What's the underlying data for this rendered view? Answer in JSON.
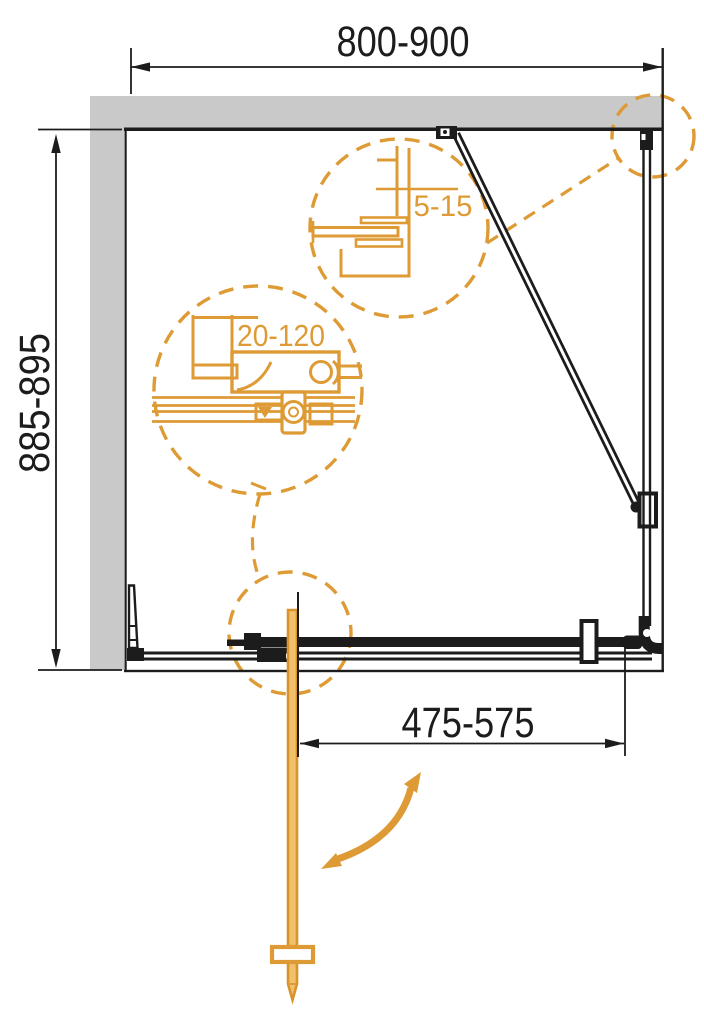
{
  "dimensions": {
    "top": {
      "label": "800-900"
    },
    "left": {
      "label": "885-895"
    },
    "bottom": {
      "label": "475-575"
    }
  },
  "details": {
    "wall_gap_circle": {
      "label": "5-15"
    },
    "adjustment_circle": {
      "label": "20-120"
    }
  },
  "colors": {
    "accent_orange": "#de9b35",
    "door_fill": "#f1c06a",
    "door_stroke": "#d8942c",
    "line_black": "#1c1c1c",
    "wall_gray": "#c9c9c9"
  }
}
